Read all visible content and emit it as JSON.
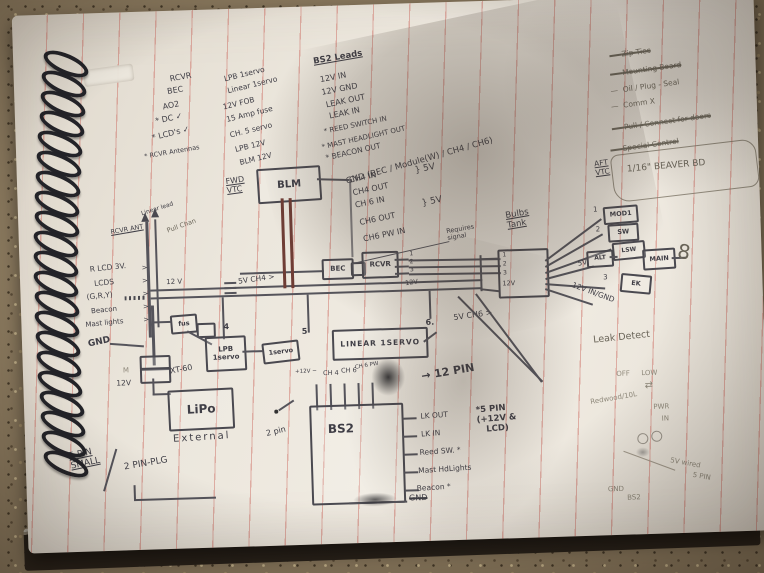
{
  "colors": {
    "ink": "#3f3e46",
    "pencil": "#8f897b",
    "ruled_line": "#c7584e",
    "floor": "#8a795e",
    "page": "#ece7dd",
    "wire": "#55545b",
    "red_wire": "#6f3d35",
    "coil": "#232328"
  },
  "notes": {
    "col1": [
      "RCVR",
      "BEC",
      "AO2",
      "* DC ✓",
      "* LCD's ✓",
      "* RCVR Antennas"
    ],
    "col2": [
      "LPB 1servo",
      "Linear 1servo",
      "12V FOB",
      "15 Amp fuse",
      "CH. 5 servo",
      "LPB 12V",
      "BLM 12V"
    ],
    "bs2_title": "BS2 Leads",
    "bs2": [
      "12V IN",
      "12V GND",
      "LEAK OUT",
      "LEAK IN",
      "* REED SWITCH IN",
      "* MAST HEADLIGHT OUT",
      "* BEACON OUT",
      "GND (BEC / Module(W) / CH4 / CH6)",
      "CH4 IN",
      "CH4 OUT",
      "CH 6 IN",
      "CH6 OUT",
      "CH6 PW IN"
    ],
    "brace_5v": "} 5V",
    "todo": [
      {
        "label": "Zip Ties",
        "struck": true
      },
      {
        "label": "Mounting Board",
        "struck": true
      },
      {
        "label": "Oil / Plug - Seal",
        "struck": false
      },
      {
        "label": "Comm X",
        "struck": false
      },
      {
        "label": "Pull / Connect for doors",
        "struck": true
      },
      {
        "label": "Special Control",
        "struck": true
      }
    ]
  },
  "d": {
    "fwd_vtc": "FWD\nVTC",
    "aft_vtc": "AFT\nVTC",
    "beaver": "1/16\" BEAVER BD",
    "linear_lead": "Linear lead",
    "rcvr_ant": "RCVR ANT",
    "pull_chan": "Pull Chan",
    "r_lcd_3v": "R LCD 3V.",
    "lcds": "LCDS",
    "gry": "(G,R,Y)",
    "beacon": "Beacon",
    "mast_lights": "Mast lights",
    "gnd": "GND",
    "v12_a": "12 V",
    "v12_b": "12V",
    "v12_c": "12V",
    "v12_d": "12V",
    "m": "M",
    "blm": "BLM",
    "bec": "BEC",
    "rcvr": "RCVR",
    "fuse": "fus",
    "five_v_ch4": "5V CH4 >",
    "five_v_ch6": "5V CH6 >",
    "n4": "4",
    "n5": "5",
    "n6": "6.",
    "requires": "Requires\nsignal",
    "lpb": "LPB\n1servo",
    "servo": "1servo",
    "linear": "LINEAR 1SERVO",
    "xt60": "XT-60",
    "lipo": "LiPo",
    "external": "External",
    "bulbs_tank": "Bulbs\nTank",
    "p1": "1",
    "p2": "2",
    "p3": "3",
    "five_v": "5V",
    "v12_in_gnd": "12V IN/GND",
    "fo1": "1",
    "fo2": "2",
    "fo3": "3",
    "mod1": "MOD1",
    "sw": "SW",
    "alt": "ALT",
    "lsw": "LSW",
    "ek": "EK",
    "main": "MAIN",
    "bow": "8",
    "leak_detect": "Leak Detect",
    "two_pin": "2 pin",
    "twelve_pin": "→ 12 PIN",
    "bs2": "BS2",
    "bs2_top": [
      "+12V −",
      "CH 4",
      "CH 6",
      "CH 6 PW"
    ],
    "bs2_right": [
      "LK OUT",
      "LK IN",
      "Reed SW. *",
      "Mast HdLights",
      "Beacon *"
    ],
    "bs2_gnd": "GND",
    "five_pin_note": "*5 PIN\n(+12V &\n   LCD)",
    "five_pin_small": "5 PIN\nSMALL",
    "two_pin_plg": "2 PIN-PLG",
    "pencil": {
      "off": "OFF",
      "low": "LOW",
      "swap": "⇄",
      "redwood": "Redwood/10L",
      "pwr": "PWR",
      "pin_in": "IN",
      "wired": "5V wired",
      "five_pin": "5 PIN",
      "gnd": "GND",
      "bs2": "BS2"
    },
    "arrow_r": ">"
  }
}
